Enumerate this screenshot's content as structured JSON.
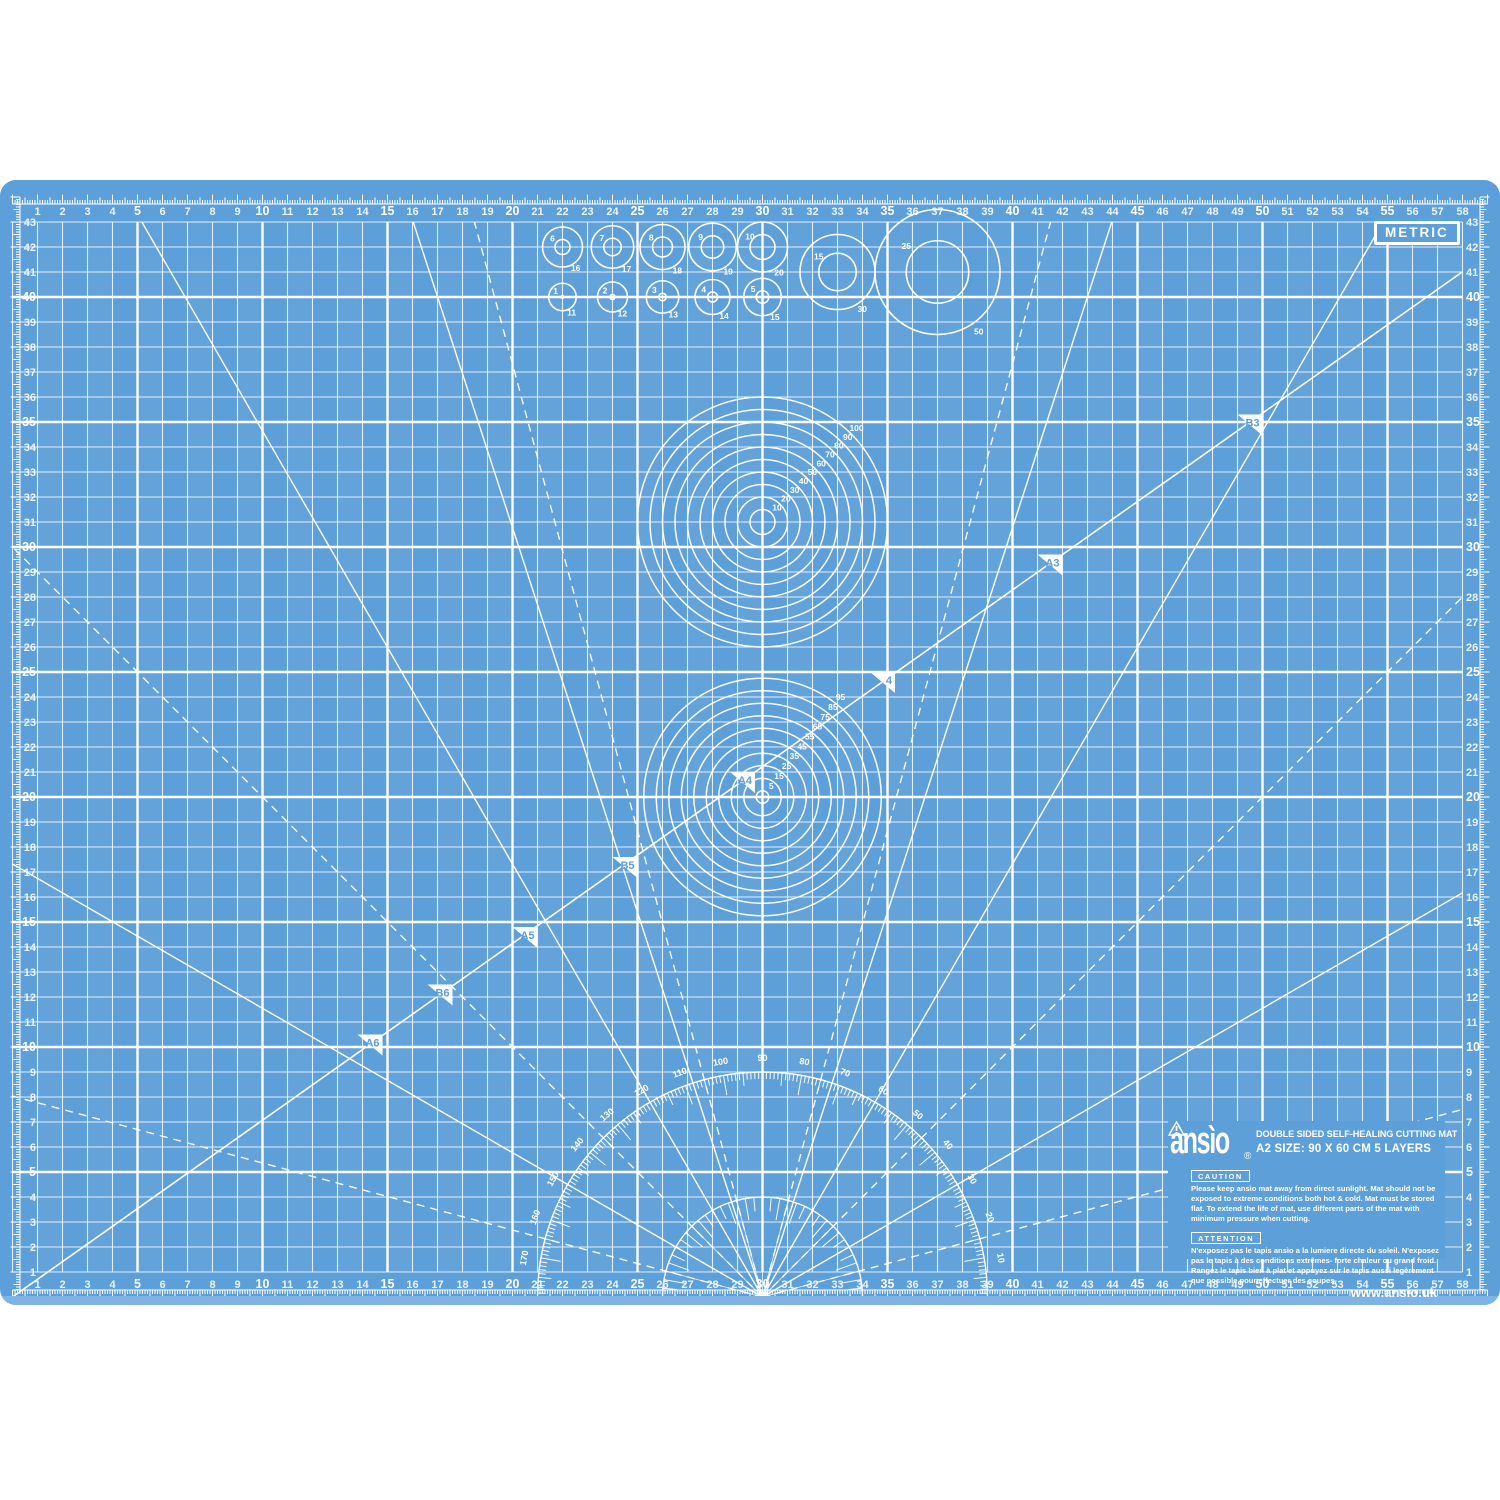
{
  "mat": {
    "badge": "METRIC",
    "colors": {
      "surface": "#5c9fd9",
      "edge_band": "#7fb3e6",
      "line": "#ffffff"
    },
    "rulers": {
      "h_labels": [
        1,
        2,
        3,
        4,
        5,
        6,
        7,
        8,
        9,
        10,
        11,
        12,
        13,
        14,
        15,
        16,
        17,
        18,
        19,
        20,
        21,
        22,
        23,
        24,
        25,
        26,
        27,
        28,
        29,
        30,
        31,
        32,
        33,
        34,
        35,
        36,
        37,
        38,
        39,
        40,
        41,
        42,
        43,
        44,
        45,
        46,
        47,
        48,
        49,
        50,
        51,
        52,
        53,
        54,
        55,
        56,
        57,
        58
      ],
      "v_labels": [
        1,
        2,
        3,
        4,
        5,
        6,
        7,
        8,
        9,
        10,
        11,
        12,
        13,
        14,
        15,
        16,
        17,
        18,
        19,
        20,
        21,
        22,
        23,
        24,
        25,
        26,
        27,
        28,
        29,
        30,
        31,
        32,
        33,
        34,
        35,
        36,
        37,
        38,
        39,
        40,
        41,
        42,
        43
      ],
      "bold_every": 5
    },
    "paper_markers": [
      {
        "label": "A6",
        "w_cm": 14.8,
        "h_cm": 10.5
      },
      {
        "label": "B6",
        "w_cm": 17.6,
        "h_cm": 12.5
      },
      {
        "label": "A5",
        "w_cm": 21.0,
        "h_cm": 14.8
      },
      {
        "label": "B5",
        "w_cm": 25.0,
        "h_cm": 17.6
      },
      {
        "label": "A4",
        "w_cm": 29.7,
        "h_cm": 21.0
      },
      {
        "label": "4",
        "w_cm": 35.3,
        "h_cm": 25.0
      },
      {
        "label": "A3",
        "w_cm": 42.0,
        "h_cm": 29.7
      },
      {
        "label": "B3",
        "w_cm": 50.0,
        "h_cm": 35.3
      }
    ],
    "diagonal": {
      "rise": 210,
      "run": 297
    },
    "rays": {
      "solid_deg": [
        30,
        60,
        72,
        108,
        120,
        150
      ],
      "dashed_deg": [
        15,
        45,
        75,
        105,
        135,
        165
      ]
    },
    "concentric_sets": [
      {
        "cx_cm": 30,
        "cy_cm": 31,
        "diameter_labels_mm": [
          10,
          20,
          30,
          40,
          50,
          60,
          70,
          80,
          90,
          100
        ],
        "label_angle_deg": 45
      },
      {
        "cx_cm": 30,
        "cy_cm": 20,
        "diameter_labels_mm": [
          5,
          15,
          25,
          35,
          45,
          55,
          65,
          75,
          85,
          95
        ],
        "label_angle_deg": 52
      }
    ],
    "circle_gauges": {
      "small_top": {
        "y_cm": 42,
        "x_cm": [
          22,
          24,
          26,
          28,
          30
        ],
        "inner_mm": [
          6,
          7,
          8,
          9,
          10
        ],
        "outer_mm": [
          16,
          17,
          18,
          19,
          20
        ]
      },
      "small_bottom": {
        "y_cm": 40,
        "x_cm": [
          22,
          24,
          26,
          28,
          30
        ],
        "inner_mm": [
          1,
          2,
          3,
          4,
          5
        ],
        "outer_mm": [
          11,
          12,
          13,
          14,
          15
        ]
      },
      "large": [
        {
          "x_cm": 33,
          "y_cm": 41,
          "inner_mm": 15,
          "outer_mm": 30
        },
        {
          "x_cm": 37,
          "y_cm": 41,
          "inner_mm": 25,
          "outer_mm": 50
        }
      ]
    },
    "protractor": {
      "outer_radius_mm": 90,
      "inner_radius_mm": 40,
      "degree_labels": [
        10,
        20,
        30,
        40,
        50,
        60,
        70,
        80,
        90,
        100,
        110,
        120,
        130,
        140,
        150,
        160,
        170
      ]
    },
    "info": {
      "brand": "ansìo",
      "registered": "®",
      "title": "DOUBLE SIDED SELF-HEALING CUTTING MAT",
      "size_line": "A2 SIZE: 90 X 60 CM 5 LAYERS",
      "caution_label": "CAUTION",
      "caution_text": "Please keep ansìo mat away from direct sunlight. Mat should not be exposed to extreme conditions both hot & cold. Mat must be stored flat. To extend the life of mat, use different parts of the mat with minimum pressure when cutting.",
      "attention_label": "ATTENTION",
      "attention_text": "N'exposez pas le tapis ansìo a la lumiere directe du soleil. N'exposez pas le tapis à des conditions extrêmes- forte chaleur ou grand froid. Rangez le tapis bien à plat et appuyez sur le tapis aussi legèrement que possible pour effectuer des coupes.",
      "website": "www.ansio.uk"
    }
  }
}
